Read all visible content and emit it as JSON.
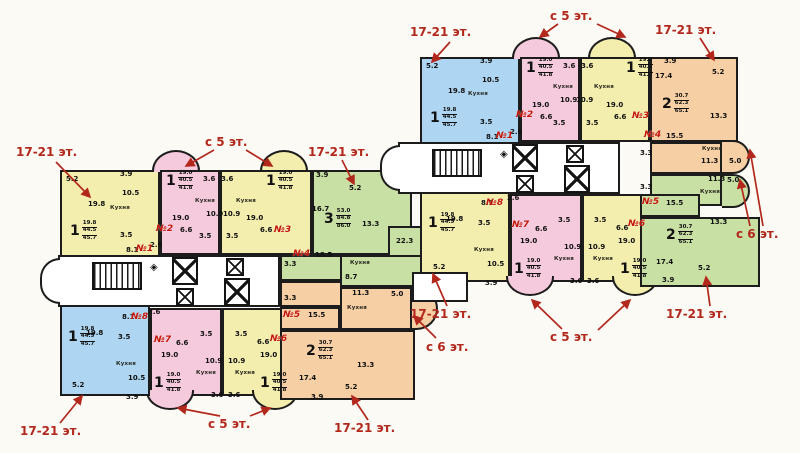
{
  "plan": {
    "canvas": {
      "w": 800,
      "h": 453,
      "bg": "#fbfaf5"
    },
    "colors": {
      "wall": "#1c1c1c",
      "yellow": "#f3eeae",
      "blue": "#aed6f2",
      "pink": "#f6cadd",
      "green": "#c9e0a4",
      "orange": "#f6cfa5",
      "white": "#ffffff",
      "badge_red": "#c41408",
      "annotation_red": "#b3281c"
    },
    "rooms": [
      {
        "r": [
          60,
          170,
          100,
          95
        ],
        "c": "yellow"
      },
      {
        "r": [
          152,
          150,
          48,
          22
        ],
        "c": "pink",
        "shape": "bay-top"
      },
      {
        "r": [
          160,
          170,
          60,
          85
        ],
        "c": "pink"
      },
      {
        "r": [
          260,
          150,
          48,
          22
        ],
        "c": "yellow",
        "shape": "bay-top"
      },
      {
        "r": [
          220,
          170,
          92,
          85
        ],
        "c": "yellow"
      },
      {
        "r": [
          312,
          170,
          100,
          85
        ],
        "c": "green"
      },
      {
        "r": [
          388,
          226,
          54,
          32
        ],
        "c": "green"
      },
      {
        "r": [
          280,
          255,
          62,
          26
        ],
        "c": "green"
      },
      {
        "r": [
          340,
          255,
          95,
          32
        ],
        "c": "green"
      },
      {
        "r": [
          280,
          281,
          62,
          26
        ],
        "c": "orange"
      },
      {
        "r": [
          340,
          287,
          72,
          43
        ],
        "c": "orange"
      },
      {
        "r": [
          412,
          287,
          26,
          43
        ],
        "c": "orange",
        "shape": "semi-right"
      },
      {
        "r": [
          222,
          308,
          68,
          88
        ],
        "c": "yellow"
      },
      {
        "r": [
          252,
          390,
          46,
          20
        ],
        "c": "yellow",
        "shape": "bay-bottom"
      },
      {
        "r": [
          150,
          308,
          72,
          88
        ],
        "c": "pink"
      },
      {
        "r": [
          146,
          390,
          48,
          20
        ],
        "c": "pink",
        "shape": "bay-bottom"
      },
      {
        "r": [
          60,
          300,
          90,
          96
        ],
        "c": "blue"
      },
      {
        "r": [
          280,
          307,
          60,
          23
        ],
        "c": "orange"
      },
      {
        "r": [
          280,
          330,
          135,
          70
        ],
        "c": "orange"
      },
      {
        "r": [
          58,
          255,
          222,
          52
        ],
        "c": "white"
      },
      {
        "r": [
          40,
          258,
          20,
          46
        ],
        "c": "white",
        "shape": "semi-left"
      },
      {
        "r": [
          420,
          57,
          100,
          95
        ],
        "c": "blue"
      },
      {
        "r": [
          512,
          37,
          48,
          22
        ],
        "c": "pink",
        "shape": "bay-top"
      },
      {
        "r": [
          520,
          57,
          60,
          85
        ],
        "c": "pink"
      },
      {
        "r": [
          588,
          37,
          48,
          22
        ],
        "c": "yellow",
        "shape": "bay-top"
      },
      {
        "r": [
          580,
          57,
          70,
          85
        ],
        "c": "yellow"
      },
      {
        "r": [
          650,
          57,
          88,
          85
        ],
        "c": "orange"
      },
      {
        "r": [
          650,
          142,
          72,
          32
        ],
        "c": "orange"
      },
      {
        "r": [
          722,
          140,
          28,
          34
        ],
        "c": "orange",
        "shape": "semi-right"
      },
      {
        "r": [
          650,
          174,
          72,
          32
        ],
        "c": "green"
      },
      {
        "r": [
          722,
          174,
          28,
          34
        ],
        "c": "green",
        "shape": "semi-right"
      },
      {
        "r": [
          420,
          186,
          90,
          96
        ],
        "c": "yellow"
      },
      {
        "r": [
          582,
          194,
          68,
          88
        ],
        "c": "yellow"
      },
      {
        "r": [
          612,
          276,
          46,
          20
        ],
        "c": "yellow",
        "shape": "bay-bottom"
      },
      {
        "r": [
          510,
          194,
          72,
          88
        ],
        "c": "pink"
      },
      {
        "r": [
          506,
          276,
          48,
          20
        ],
        "c": "pink",
        "shape": "bay-bottom"
      },
      {
        "r": [
          640,
          194,
          60,
          23
        ],
        "c": "green"
      },
      {
        "r": [
          640,
          217,
          120,
          70
        ],
        "c": "green"
      },
      {
        "r": [
          398,
          142,
          222,
          52
        ],
        "c": "white"
      },
      {
        "r": [
          380,
          145,
          20,
          46
        ],
        "c": "white",
        "shape": "semi-left"
      },
      {
        "r": [
          412,
          272,
          56,
          30
        ],
        "c": "white"
      }
    ],
    "areas": [
      [
        "5.2",
        66,
        176
      ],
      [
        "3.9",
        120,
        171
      ],
      [
        "10.5",
        122,
        190
      ],
      [
        "19.8",
        88,
        201
      ],
      [
        "3.5",
        120,
        232
      ],
      [
        "8.1",
        126,
        247
      ],
      [
        "2.6",
        150,
        242
      ],
      [
        "3.6",
        203,
        176
      ],
      [
        "10.9",
        206,
        211
      ],
      [
        "19.0",
        172,
        215
      ],
      [
        "6.6",
        180,
        227
      ],
      [
        "3.5",
        199,
        233
      ],
      [
        "3.6",
        221,
        176
      ],
      [
        "10.9",
        223,
        211
      ],
      [
        "19.0",
        246,
        215
      ],
      [
        "6.6",
        260,
        227
      ],
      [
        "3.5",
        226,
        233
      ],
      [
        "3.9",
        316,
        172
      ],
      [
        "5.2",
        349,
        185
      ],
      [
        "16.7",
        312,
        206
      ],
      [
        "13.3",
        362,
        221
      ],
      [
        "22.3",
        396,
        238
      ],
      [
        "18.5",
        315,
        252
      ],
      [
        "8.7",
        345,
        274
      ],
      [
        "3.3",
        284,
        261
      ],
      [
        "11.3",
        352,
        290
      ],
      [
        "5.0",
        391,
        291
      ],
      [
        "15.5",
        308,
        312
      ],
      [
        "3.3",
        284,
        295
      ],
      [
        "13.3",
        357,
        362
      ],
      [
        "17.4",
        299,
        375
      ],
      [
        "5.2",
        345,
        384
      ],
      [
        "3.9",
        311,
        394
      ],
      [
        "3.5",
        235,
        331
      ],
      [
        "6.6",
        257,
        339
      ],
      [
        "19.0",
        260,
        352
      ],
      [
        "10.9",
        228,
        358
      ],
      [
        "3.6",
        228,
        392
      ],
      [
        "3.5",
        200,
        331
      ],
      [
        "6.6",
        176,
        340
      ],
      [
        "19.0",
        161,
        352
      ],
      [
        "10.9",
        205,
        358
      ],
      [
        "3.6",
        211,
        392
      ],
      [
        "19.8",
        86,
        330
      ],
      [
        "3.5",
        118,
        334
      ],
      [
        "8.1",
        122,
        314
      ],
      [
        "2.6",
        148,
        309
      ],
      [
        "10.5",
        128,
        375
      ],
      [
        "5.2",
        72,
        382
      ],
      [
        "3.9",
        126,
        394
      ],
      [
        "5.2",
        426,
        63
      ],
      [
        "3.9",
        480,
        58
      ],
      [
        "10.5",
        482,
        77
      ],
      [
        "19.8",
        448,
        88
      ],
      [
        "3.5",
        480,
        119
      ],
      [
        "8.1",
        486,
        134
      ],
      [
        "2.6",
        510,
        129
      ],
      [
        "3.6",
        563,
        63
      ],
      [
        "10.9",
        560,
        97
      ],
      [
        "19.0",
        532,
        102
      ],
      [
        "6.6",
        540,
        114
      ],
      [
        "3.5",
        553,
        120
      ],
      [
        "3.6",
        581,
        63
      ],
      [
        "10.9",
        576,
        97
      ],
      [
        "19.0",
        606,
        102
      ],
      [
        "6.6",
        614,
        114
      ],
      [
        "3.5",
        586,
        120
      ],
      [
        "3.9",
        664,
        58
      ],
      [
        "5.2",
        712,
        69
      ],
      [
        "17.4",
        655,
        73
      ],
      [
        "13.3",
        710,
        113
      ],
      [
        "15.5",
        666,
        133
      ],
      [
        "11.3",
        701,
        158
      ],
      [
        "5.0",
        729,
        158
      ],
      [
        "3.3",
        640,
        150
      ],
      [
        "15.5",
        666,
        200
      ],
      [
        "13.3",
        710,
        219
      ],
      [
        "17.4",
        656,
        259
      ],
      [
        "5.2",
        698,
        265
      ],
      [
        "3.9",
        662,
        277
      ],
      [
        "11.3",
        708,
        176
      ],
      [
        "5.0",
        727,
        177
      ],
      [
        "3.3",
        640,
        184
      ],
      [
        "3.5",
        594,
        217
      ],
      [
        "6.6",
        616,
        225
      ],
      [
        "19.0",
        618,
        238
      ],
      [
        "10.9",
        588,
        244
      ],
      [
        "3.6",
        587,
        278
      ],
      [
        "3.5",
        558,
        217
      ],
      [
        "6.6",
        535,
        226
      ],
      [
        "19.0",
        520,
        238
      ],
      [
        "10.9",
        564,
        244
      ],
      [
        "3.6",
        570,
        278
      ],
      [
        "19.8",
        446,
        216
      ],
      [
        "3.5",
        478,
        220
      ],
      [
        "8.1",
        481,
        200
      ],
      [
        "2.6",
        507,
        195
      ],
      [
        "10.5",
        487,
        261
      ],
      [
        "5.2",
        433,
        264
      ],
      [
        "3.9",
        485,
        280
      ]
    ],
    "kitchen_label": "Кухня",
    "kitchens": [
      [
        110,
        206
      ],
      [
        195,
        199
      ],
      [
        236,
        199
      ],
      [
        350,
        261
      ],
      [
        347,
        306
      ],
      [
        235,
        371
      ],
      [
        196,
        371
      ],
      [
        116,
        362
      ],
      [
        468,
        92
      ],
      [
        553,
        85
      ],
      [
        594,
        85
      ],
      [
        702,
        147
      ],
      [
        700,
        190
      ],
      [
        593,
        257
      ],
      [
        554,
        257
      ],
      [
        474,
        248
      ]
    ],
    "badges": [
      [
        "№1",
        136,
        245
      ],
      [
        "№2",
        156,
        225
      ],
      [
        "№3",
        274,
        226
      ],
      [
        "№4",
        293,
        250
      ],
      [
        "№5",
        283,
        311
      ],
      [
        "№6",
        270,
        335
      ],
      [
        "№7",
        154,
        336
      ],
      [
        "№8",
        131,
        313
      ],
      [
        "№1",
        496,
        132
      ],
      [
        "№2",
        516,
        111
      ],
      [
        "№3",
        632,
        112
      ],
      [
        "№4",
        644,
        131
      ],
      [
        "№5",
        642,
        198
      ],
      [
        "№6",
        628,
        220
      ],
      [
        "№7",
        512,
        221
      ],
      [
        "№8",
        486,
        199
      ]
    ],
    "headers": [
      {
        "d": "1",
        "a": [
          "19.8",
          "44.5",
          "45.7"
        ],
        "x": 70,
        "y": 220
      },
      {
        "d": "1",
        "a": [
          "19.0",
          "40.5",
          "41.8"
        ],
        "x": 166,
        "y": 170
      },
      {
        "d": "1",
        "a": [
          "19.0",
          "40.5",
          "41.8"
        ],
        "x": 266,
        "y": 170
      },
      {
        "d": "3",
        "a": [
          "53.0",
          "84.8",
          "86.0"
        ],
        "x": 324,
        "y": 208
      },
      {
        "d": "2",
        "a": [
          "30.7",
          "62.3",
          "65.1"
        ],
        "x": 306,
        "y": 340
      },
      {
        "d": "1",
        "a": [
          "19.0",
          "40.5",
          "41.8"
        ],
        "x": 260,
        "y": 372
      },
      {
        "d": "1",
        "a": [
          "19.0",
          "40.5",
          "41.8"
        ],
        "x": 154,
        "y": 372
      },
      {
        "d": "1",
        "a": [
          "19.8",
          "44.5",
          "45.7"
        ],
        "x": 68,
        "y": 326
      },
      {
        "d": "1",
        "a": [
          "19.8",
          "44.5",
          "45.7"
        ],
        "x": 430,
        "y": 107
      },
      {
        "d": "1",
        "a": [
          "19.0",
          "40.5",
          "41.8"
        ],
        "x": 526,
        "y": 57
      },
      {
        "d": "1",
        "a": [
          "19.0",
          "40.5",
          "41.8"
        ],
        "x": 626,
        "y": 57
      },
      {
        "d": "2",
        "a": [
          "30.7",
          "62.3",
          "65.1"
        ],
        "x": 662,
        "y": 93
      },
      {
        "d": "2",
        "a": [
          "30.7",
          "62.3",
          "65.1"
        ],
        "x": 666,
        "y": 224
      },
      {
        "d": "1",
        "a": [
          "19.0",
          "40.5",
          "41.8"
        ],
        "x": 620,
        "y": 258
      },
      {
        "d": "1",
        "a": [
          "19.0",
          "40.5",
          "41.8"
        ],
        "x": 514,
        "y": 258
      },
      {
        "d": "1",
        "a": [
          "19.8",
          "44.5",
          "45.7"
        ],
        "x": 428,
        "y": 212
      }
    ],
    "shafts": [
      [
        172,
        257,
        26,
        28
      ],
      [
        176,
        288,
        18,
        18
      ],
      [
        226,
        258,
        18,
        18
      ],
      [
        224,
        278,
        26,
        28
      ],
      [
        512,
        144,
        26,
        28
      ],
      [
        516,
        175,
        18,
        18
      ],
      [
        566,
        145,
        18,
        18
      ],
      [
        564,
        165,
        26,
        28
      ]
    ],
    "stairs": [
      [
        92,
        262,
        50,
        28
      ],
      [
        432,
        149,
        50,
        28
      ]
    ],
    "diamond_glyph": "◈",
    "diamonds": [
      [
        150,
        263
      ],
      [
        500,
        150
      ]
    ],
    "annotations": [
      {
        "t": "17-21 эт.",
        "x": 16,
        "y": 146,
        "arrows": [
          [
            56,
            162,
            90,
            197
          ]
        ]
      },
      {
        "t": "с 5 эт.",
        "x": 205,
        "y": 136,
        "arrows": [
          [
            214,
            150,
            186,
            166
          ],
          [
            246,
            150,
            272,
            166
          ]
        ]
      },
      {
        "t": "17-21 эт.",
        "x": 308,
        "y": 146,
        "arrows": [
          [
            342,
            160,
            354,
            184
          ]
        ]
      },
      {
        "t": "17-21 эт.",
        "x": 410,
        "y": 26,
        "arrows": [
          [
            450,
            42,
            432,
            62
          ]
        ]
      },
      {
        "t": "с 5 эт.",
        "x": 550,
        "y": 10,
        "arrows": [
          [
            558,
            24,
            540,
            37
          ],
          [
            597,
            24,
            625,
            37
          ]
        ]
      },
      {
        "t": "17-21 эт.",
        "x": 655,
        "y": 24,
        "arrows": [
          [
            700,
            38,
            714,
            60
          ]
        ]
      },
      {
        "t": "с 6 эт.",
        "x": 736,
        "y": 228,
        "arrows": [
          [
            750,
            226,
            740,
            180
          ],
          [
            763,
            226,
            750,
            150
          ]
        ]
      },
      {
        "t": "17-21 эт.",
        "x": 410,
        "y": 308,
        "arrows": [
          [
            447,
            306,
            433,
            274
          ]
        ]
      },
      {
        "t": "с 6 эт.",
        "x": 426,
        "y": 341,
        "arrows": [
          [
            436,
            338,
            414,
            316
          ]
        ]
      },
      {
        "t": "с 5 эт.",
        "x": 550,
        "y": 331,
        "arrows": [
          [
            562,
            329,
            532,
            300
          ],
          [
            598,
            330,
            630,
            300
          ]
        ]
      },
      {
        "t": "17-21 эт.",
        "x": 666,
        "y": 308,
        "arrows": [
          [
            710,
            306,
            706,
            277
          ]
        ]
      },
      {
        "t": "17-21 эт.",
        "x": 20,
        "y": 425,
        "arrows": [
          [
            60,
            423,
            82,
            396
          ]
        ]
      },
      {
        "t": "с 5 эт.",
        "x": 208,
        "y": 418,
        "arrows": [
          [
            220,
            416,
            178,
            408
          ],
          [
            250,
            416,
            270,
            408
          ]
        ]
      },
      {
        "t": "17-21 эт.",
        "x": 334,
        "y": 422,
        "arrows": [
          [
            368,
            420,
            352,
            396
          ]
        ]
      }
    ]
  }
}
